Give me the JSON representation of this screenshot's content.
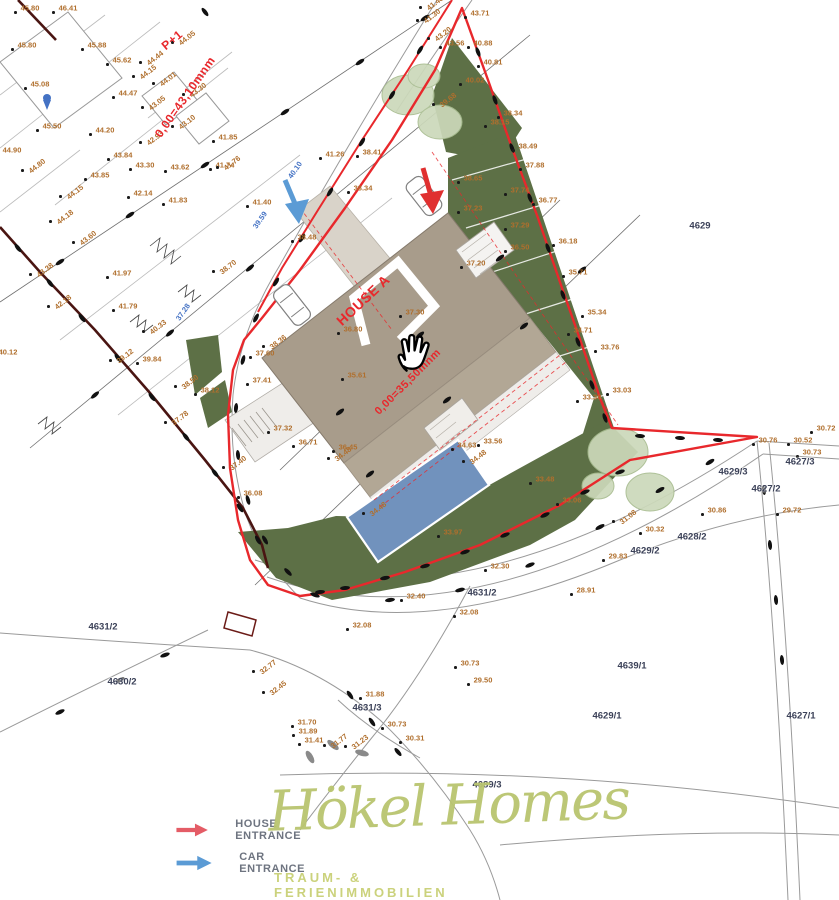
{
  "canvas": {
    "w": 839,
    "h": 900
  },
  "colors": {
    "boundary_red": "#e8282c",
    "road_maroon": "#4a1512",
    "house_tan": "#a89c8b",
    "deck_tan": "#b2a795",
    "pool_blue": "#7192bd",
    "grass_green": "#5d7046",
    "tree_green": "#ccd9ba",
    "elevation_text": "#b06f2d",
    "parcel_text": "#3b4158",
    "blue_note": "#4472c4",
    "legend_red_arrow": "#e45c66",
    "legend_blue_arrow": "#5b9bd5",
    "logo_olive": "#b9c56f",
    "tagline_olive": "#cbd27c"
  },
  "red_labels": [
    {
      "text": "P+1",
      "x": 172,
      "y": 40,
      "rot": -40,
      "size": 12
    },
    {
      "text": "0,00=43,10mnm",
      "x": 185,
      "y": 97,
      "rot": -55,
      "size": 12
    },
    {
      "text": "HOUSE A",
      "x": 363,
      "y": 300,
      "rot": -43,
      "size": 14
    },
    {
      "text": "0,00=35,50mnm",
      "x": 408,
      "y": 382,
      "rot": -45,
      "size": 11
    }
  ],
  "blue_labels": [
    {
      "text": "37.28",
      "x": 183,
      "y": 312,
      "rot": -55
    },
    {
      "text": "40.10",
      "x": 295,
      "y": 170,
      "rot": -55
    },
    {
      "text": "39.59",
      "x": 260,
      "y": 220,
      "rot": -55
    }
  ],
  "parcel_labels": [
    {
      "text": "4629",
      "x": 700,
      "y": 226
    },
    {
      "text": "4627/3",
      "x": 800,
      "y": 462
    },
    {
      "text": "4629/3",
      "x": 733,
      "y": 472
    },
    {
      "text": "4627/2",
      "x": 766,
      "y": 489
    },
    {
      "text": "4628/2",
      "x": 692,
      "y": 537
    },
    {
      "text": "4629/2",
      "x": 645,
      "y": 551
    },
    {
      "text": "4631/2",
      "x": 482,
      "y": 593
    },
    {
      "text": "4631/2",
      "x": 103,
      "y": 627
    },
    {
      "text": "4630/2",
      "x": 122,
      "y": 682
    },
    {
      "text": "4631/3",
      "x": 367,
      "y": 708
    },
    {
      "text": "4639/1",
      "x": 632,
      "y": 666
    },
    {
      "text": "4629/1",
      "x": 607,
      "y": 716
    },
    {
      "text": "4627/1",
      "x": 801,
      "y": 716
    },
    {
      "text": "4689/3",
      "x": 487,
      "y": 785
    }
  ],
  "elevation_labels": [
    {
      "t": "46.41",
      "x": 68,
      "y": 8
    },
    {
      "t": "45.80",
      "x": 30,
      "y": 8
    },
    {
      "t": "45.80",
      "x": 27,
      "y": 45
    },
    {
      "t": "45.88",
      "x": 97,
      "y": 45
    },
    {
      "t": "45.62",
      "x": 122,
      "y": 60
    },
    {
      "t": "45.08",
      "x": 40,
      "y": 84
    },
    {
      "t": "44.47",
      "x": 128,
      "y": 93
    },
    {
      "t": "45.50",
      "x": 52,
      "y": 126
    },
    {
      "t": "44.20",
      "x": 105,
      "y": 130
    },
    {
      "t": "44.90",
      "x": 12,
      "y": 150
    },
    {
      "t": "44.05",
      "x": 187,
      "y": 38,
      "r": 1
    },
    {
      "t": "44.44",
      "x": 155,
      "y": 58,
      "r": 1
    },
    {
      "t": "44.15",
      "x": 148,
      "y": 72,
      "r": 1
    },
    {
      "t": "44.01",
      "x": 168,
      "y": 79,
      "r": 1
    },
    {
      "t": "43.30",
      "x": 198,
      "y": 90,
      "r": 1
    },
    {
      "t": "43.05",
      "x": 157,
      "y": 103,
      "r": 1
    },
    {
      "t": "43.10",
      "x": 187,
      "y": 122,
      "r": 1
    },
    {
      "t": "42.93",
      "x": 155,
      "y": 138,
      "r": 1
    },
    {
      "t": "41.85",
      "x": 228,
      "y": 137
    },
    {
      "t": "44.80",
      "x": 37,
      "y": 166,
      "r": 1
    },
    {
      "t": "43.84",
      "x": 123,
      "y": 155
    },
    {
      "t": "43.85",
      "x": 100,
      "y": 175
    },
    {
      "t": "43.30",
      "x": 145,
      "y": 165
    },
    {
      "t": "43.62",
      "x": 180,
      "y": 167
    },
    {
      "t": "41.74",
      "x": 225,
      "y": 165
    },
    {
      "t": "44.15",
      "x": 75,
      "y": 192,
      "r": 1
    },
    {
      "t": "42.14",
      "x": 143,
      "y": 193
    },
    {
      "t": "41.83",
      "x": 178,
      "y": 200
    },
    {
      "t": "44.18",
      "x": 65,
      "y": 217,
      "r": 1
    },
    {
      "t": "43.60",
      "x": 88,
      "y": 238,
      "r": 1
    },
    {
      "t": "43.38",
      "x": 45,
      "y": 270,
      "r": 1
    },
    {
      "t": "41.97",
      "x": 122,
      "y": 273
    },
    {
      "t": "42.18",
      "x": 63,
      "y": 302,
      "r": 1
    },
    {
      "t": "41.79",
      "x": 128,
      "y": 306
    },
    {
      "t": "40.33",
      "x": 158,
      "y": 327,
      "r": 1
    },
    {
      "t": "39.12",
      "x": 125,
      "y": 356,
      "r": 1
    },
    {
      "t": "39.84",
      "x": 152,
      "y": 359
    },
    {
      "t": "40.12",
      "x": 8,
      "y": 352
    },
    {
      "t": "38.70",
      "x": 228,
      "y": 267,
      "r": 1
    },
    {
      "t": "41.26",
      "x": 335,
      "y": 154
    },
    {
      "t": "41.76",
      "x": 232,
      "y": 163,
      "r": 1
    },
    {
      "t": "41.40",
      "x": 262,
      "y": 202
    },
    {
      "t": "38.41",
      "x": 372,
      "y": 152
    },
    {
      "t": "38.34",
      "x": 363,
      "y": 188
    },
    {
      "t": "38.48",
      "x": 307,
      "y": 237
    },
    {
      "t": "38.36",
      "x": 278,
      "y": 342,
      "r": 1
    },
    {
      "t": "37.60",
      "x": 265,
      "y": 353
    },
    {
      "t": "37.41",
      "x": 262,
      "y": 380
    },
    {
      "t": "37.32",
      "x": 283,
      "y": 428
    },
    {
      "t": "36.71",
      "x": 308,
      "y": 442
    },
    {
      "t": "36.45",
      "x": 348,
      "y": 447
    },
    {
      "t": "37.40",
      "x": 238,
      "y": 463,
      "r": 1
    },
    {
      "t": "38.50",
      "x": 190,
      "y": 382,
      "r": 1
    },
    {
      "t": "38.12",
      "x": 210,
      "y": 390
    },
    {
      "t": "37.78",
      "x": 180,
      "y": 418,
      "r": 1
    },
    {
      "t": "36.08",
      "x": 253,
      "y": 493
    },
    {
      "t": "41.48",
      "x": 435,
      "y": 3,
      "r": 1
    },
    {
      "t": "41.30",
      "x": 432,
      "y": 16,
      "r": 1
    },
    {
      "t": "43.71",
      "x": 480,
      "y": 13
    },
    {
      "t": "43.20",
      "x": 443,
      "y": 34,
      "r": 1
    },
    {
      "t": "43.56",
      "x": 455,
      "y": 43
    },
    {
      "t": "40.88",
      "x": 483,
      "y": 43
    },
    {
      "t": "40.81",
      "x": 493,
      "y": 62
    },
    {
      "t": "40.02",
      "x": 475,
      "y": 80
    },
    {
      "t": "39.68",
      "x": 448,
      "y": 100,
      "r": 1
    },
    {
      "t": "38.34",
      "x": 513,
      "y": 113
    },
    {
      "t": "38.15",
      "x": 500,
      "y": 122
    },
    {
      "t": "38.49",
      "x": 528,
      "y": 146
    },
    {
      "t": "37.88",
      "x": 535,
      "y": 165
    },
    {
      "t": "38.65",
      "x": 473,
      "y": 178
    },
    {
      "t": "36.77",
      "x": 548,
      "y": 200
    },
    {
      "t": "37.74",
      "x": 520,
      "y": 190
    },
    {
      "t": "37.23",
      "x": 473,
      "y": 208
    },
    {
      "t": "37.29",
      "x": 520,
      "y": 225
    },
    {
      "t": "36.50",
      "x": 520,
      "y": 247
    },
    {
      "t": "37.20",
      "x": 476,
      "y": 263
    },
    {
      "t": "36.18",
      "x": 568,
      "y": 241
    },
    {
      "t": "35.71",
      "x": 578,
      "y": 272
    },
    {
      "t": "35.34",
      "x": 597,
      "y": 312
    },
    {
      "t": "34.71",
      "x": 583,
      "y": 330
    },
    {
      "t": "33.76",
      "x": 610,
      "y": 347
    },
    {
      "t": "33.38",
      "x": 592,
      "y": 397
    },
    {
      "t": "33.03",
      "x": 622,
      "y": 390
    },
    {
      "t": "30.76",
      "x": 768,
      "y": 440
    },
    {
      "t": "30.52",
      "x": 803,
      "y": 440
    },
    {
      "t": "30.72",
      "x": 826,
      "y": 428
    },
    {
      "t": "30.73",
      "x": 812,
      "y": 452
    },
    {
      "t": "31.08",
      "x": 628,
      "y": 517,
      "r": 1
    },
    {
      "t": "30.32",
      "x": 655,
      "y": 529
    },
    {
      "t": "29.83",
      "x": 618,
      "y": 556
    },
    {
      "t": "30.86",
      "x": 717,
      "y": 510
    },
    {
      "t": "29.72",
      "x": 792,
      "y": 510
    },
    {
      "t": "37.30",
      "x": 415,
      "y": 312
    },
    {
      "t": "36.80",
      "x": 353,
      "y": 329
    },
    {
      "t": "35.61",
      "x": 357,
      "y": 375
    },
    {
      "t": "34.63",
      "x": 467,
      "y": 445
    },
    {
      "t": "34.48",
      "x": 478,
      "y": 457,
      "r": 1
    },
    {
      "t": "33.56",
      "x": 493,
      "y": 441
    },
    {
      "t": "34.48",
      "x": 343,
      "y": 454,
      "r": 1
    },
    {
      "t": "34.48",
      "x": 378,
      "y": 509,
      "r": 1
    },
    {
      "t": "33.48",
      "x": 545,
      "y": 479
    },
    {
      "t": "33.06",
      "x": 572,
      "y": 500
    },
    {
      "t": "33.97",
      "x": 453,
      "y": 532
    },
    {
      "t": "32.30",
      "x": 500,
      "y": 566
    },
    {
      "t": "32.40",
      "x": 416,
      "y": 596
    },
    {
      "t": "32.08",
      "x": 469,
      "y": 612
    },
    {
      "t": "32.08",
      "x": 362,
      "y": 625
    },
    {
      "t": "31.88",
      "x": 375,
      "y": 694
    },
    {
      "t": "32.77",
      "x": 268,
      "y": 667,
      "r": 1
    },
    {
      "t": "32.45",
      "x": 278,
      "y": 688,
      "r": 1
    },
    {
      "t": "31.70",
      "x": 307,
      "y": 722
    },
    {
      "t": "31.89",
      "x": 308,
      "y": 731
    },
    {
      "t": "31.41",
      "x": 314,
      "y": 740
    },
    {
      "t": "31.77",
      "x": 339,
      "y": 741,
      "r": 1
    },
    {
      "t": "31.23",
      "x": 360,
      "y": 742,
      "r": 1
    },
    {
      "t": "30.73",
      "x": 397,
      "y": 724
    },
    {
      "t": "30.31",
      "x": 415,
      "y": 738
    },
    {
      "t": "30.73",
      "x": 470,
      "y": 663
    },
    {
      "t": "29.50",
      "x": 483,
      "y": 680
    },
    {
      "t": "28.91",
      "x": 586,
      "y": 590
    }
  ],
  "survey_marks": [
    [
      18,
      248,
      52
    ],
    [
      50,
      283,
      52
    ],
    [
      82,
      318,
      52
    ],
    [
      118,
      358,
      52
    ],
    [
      152,
      397,
      52
    ],
    [
      186,
      437,
      52
    ],
    [
      215,
      473,
      52
    ],
    [
      240,
      508,
      55
    ],
    [
      258,
      540,
      60
    ],
    [
      420,
      50,
      122
    ],
    [
      392,
      95,
      122
    ],
    [
      362,
      142,
      122
    ],
    [
      330,
      192,
      122
    ],
    [
      302,
      238,
      122
    ],
    [
      276,
      282,
      122
    ],
    [
      256,
      318,
      118
    ],
    [
      243,
      360,
      105
    ],
    [
      236,
      408,
      95
    ],
    [
      238,
      455,
      85
    ],
    [
      248,
      500,
      75
    ],
    [
      265,
      540,
      60
    ],
    [
      288,
      572,
      45
    ],
    [
      315,
      595,
      20
    ],
    [
      478,
      52,
      70
    ],
    [
      495,
      100,
      70
    ],
    [
      512,
      148,
      70
    ],
    [
      530,
      198,
      70
    ],
    [
      548,
      248,
      70
    ],
    [
      563,
      295,
      70
    ],
    [
      578,
      342,
      70
    ],
    [
      592,
      385,
      70
    ],
    [
      605,
      418,
      70
    ],
    [
      640,
      436,
      3
    ],
    [
      680,
      438,
      3
    ],
    [
      718,
      440,
      3
    ],
    [
      620,
      472,
      -18
    ],
    [
      585,
      492,
      -22
    ],
    [
      545,
      515,
      -25
    ],
    [
      505,
      535,
      -22
    ],
    [
      465,
      552,
      -18
    ],
    [
      425,
      566,
      -15
    ],
    [
      385,
      578,
      -10
    ],
    [
      345,
      588,
      -5
    ],
    [
      370,
      474,
      -38
    ],
    [
      447,
      400,
      -38
    ],
    [
      524,
      326,
      -38
    ],
    [
      582,
      270,
      -38
    ],
    [
      340,
      412,
      -38
    ],
    [
      420,
      335,
      -38
    ],
    [
      500,
      258,
      -38
    ],
    [
      60,
      262,
      -34
    ],
    [
      130,
      215,
      -34
    ],
    [
      205,
      165,
      -34
    ],
    [
      285,
      112,
      -34
    ],
    [
      360,
      62,
      -34
    ],
    [
      425,
      18,
      -34
    ],
    [
      95,
      395,
      -40
    ],
    [
      170,
      333,
      -40
    ],
    [
      250,
      268,
      -40
    ],
    [
      320,
      592,
      -5
    ],
    [
      390,
      600,
      -8
    ],
    [
      460,
      590,
      -15
    ],
    [
      530,
      565,
      -22
    ],
    [
      600,
      527,
      -28
    ],
    [
      660,
      490,
      -30
    ],
    [
      710,
      462,
      -32
    ],
    [
      350,
      695,
      55
    ],
    [
      372,
      722,
      55
    ],
    [
      398,
      752,
      50
    ],
    [
      60,
      712,
      -25
    ],
    [
      120,
      680,
      -25
    ],
    [
      165,
      655,
      -20
    ],
    [
      764,
      490,
      85
    ],
    [
      770,
      545,
      85
    ],
    [
      776,
      600,
      85
    ],
    [
      782,
      660,
      85
    ],
    [
      205,
      12,
      52
    ]
  ],
  "gray_marks": [
    [
      333,
      745,
      40
    ],
    [
      362,
      753,
      15
    ],
    [
      310,
      757,
      60
    ]
  ],
  "legend": {
    "items": [
      {
        "label": "HOUSE ENTRANCE",
        "arrow": "red"
      },
      {
        "label": "CAR ENTRANCE",
        "arrow": "blue"
      }
    ]
  },
  "branding": {
    "logo": "Hökel Homes",
    "tagline": "TRAUM- & FERIENIMMOBILIEN IN KROATIEN"
  },
  "cursor": {
    "type": "open-hand-drag"
  }
}
